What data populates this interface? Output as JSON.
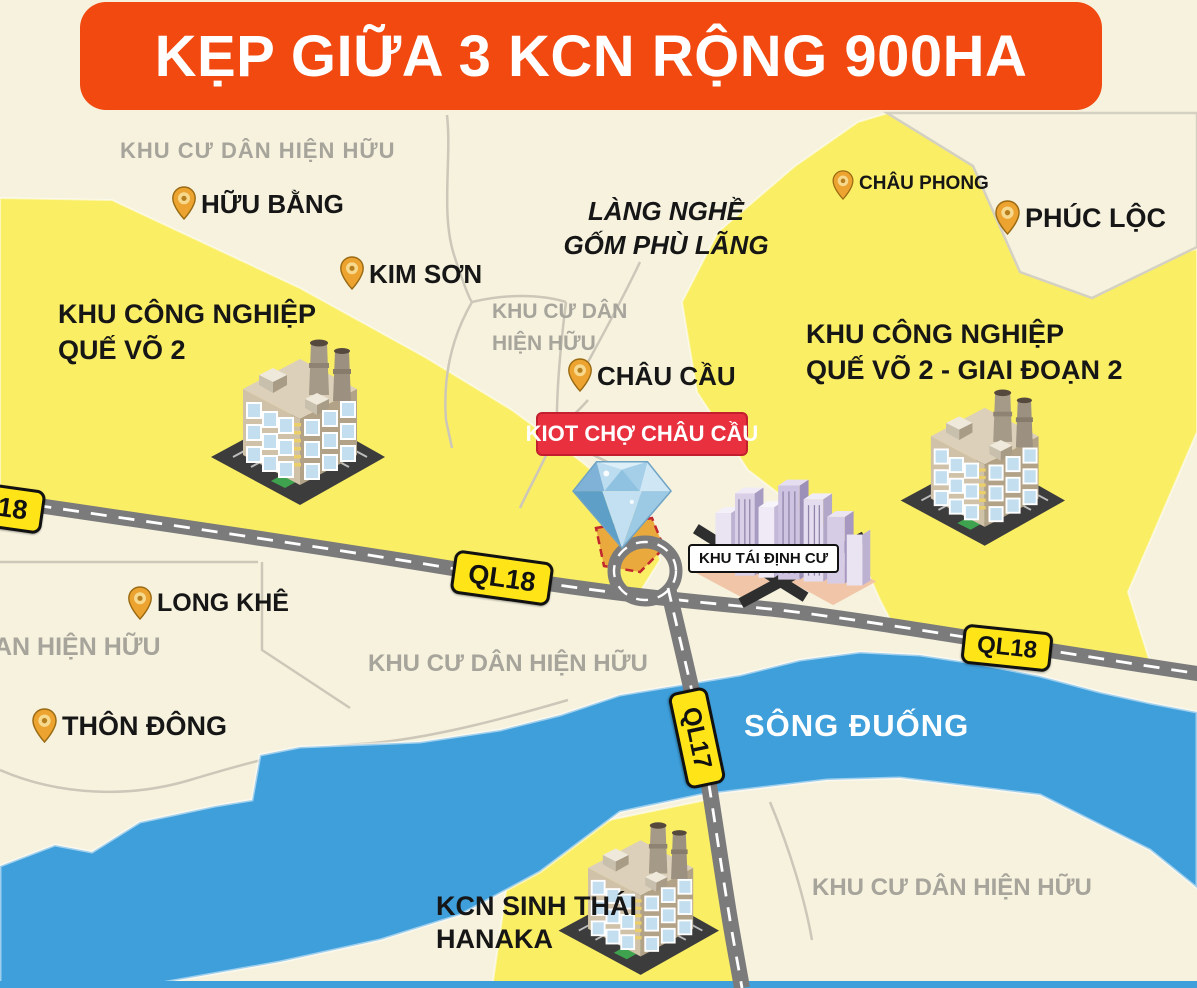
{
  "theme": {
    "banner_bg": "#F1490F",
    "banner_text_color": "#FFFFFF",
    "map_bg": "#F6F2DE",
    "zone_yellow": "#FAEE65",
    "river_blue": "#3E9FDB",
    "road_gray": "#7B7B7B",
    "road_dash": "#FFFFFF",
    "minor_road": "#CCC7B8",
    "badge_yellow": "#FFE417",
    "badge_border": "#111111",
    "kiot_badge_red": "#E8303E",
    "pin_gold": "#ECA32F",
    "label_dark": "#161616",
    "label_gray": "#A7A49B",
    "plot_gold": "#E9A93C",
    "plot_border_red": "#C1272D"
  },
  "banner": {
    "title": "KẸP GIỮA 3 KCN RỘNG 900HA"
  },
  "zones": {
    "left": {
      "line1": "KHU CÔNG NGHIỆP",
      "line2": "QUẾ VÕ 2"
    },
    "right": {
      "line1": "KHU CÔNG NGHIỆP",
      "line2": "QUẾ VÕ 2 - GIAI ĐOẠN 2"
    },
    "bottom": {
      "line1": "KCN SINH THÁI",
      "line2": "HANAKA"
    }
  },
  "places": [
    {
      "name": "HỮU BẰNG"
    },
    {
      "name": "KIM SƠN"
    },
    {
      "name": "CHÂU CẦU"
    },
    {
      "name": "CHÂU PHONG"
    },
    {
      "name": "PHÚC LỘC"
    },
    {
      "name": "LONG KHÊ"
    },
    {
      "name": "THÔN ĐÔNG"
    }
  ],
  "residential": {
    "top": {
      "text": "KHU CƯ DÂN HIỆN HỮU"
    },
    "mid": {
      "line1": "KHU CƯ DÂN",
      "line2": "HIỆN HỮU"
    },
    "below_ql18": {
      "text": "KHU CƯ DÂN HIỆN HỮU"
    },
    "left_partial": {
      "text": "AN HIỆN HỮU"
    },
    "bottom_right": {
      "text": "KHU CƯ DÂN HIỆN HỮU"
    }
  },
  "landmarks": {
    "craft_village_line1": "LÀNG NGHỀ",
    "craft_village_line2": "GỐM PHÙ LÃNG",
    "kiot_badge": "KIOT CHỢ CHÂU CẦU",
    "resettlement_badge": "KHU TÁI ĐỊNH CƯ",
    "river_name": "SÔNG ĐUỐNG"
  },
  "road_badges": {
    "ql18": "QL18",
    "ql17": "QL17"
  }
}
